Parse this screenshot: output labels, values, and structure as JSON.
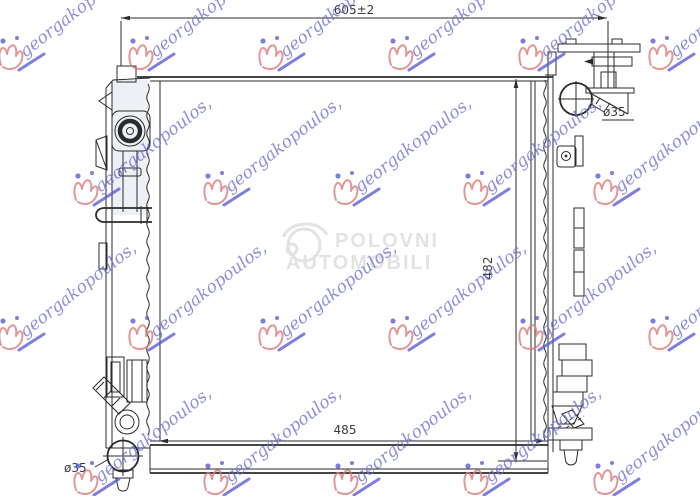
{
  "drawing": {
    "type": "technical-drawing",
    "subject": "radiator front view",
    "line_color": "#2b2b2b",
    "dimensions": {
      "top_width": "605±2",
      "height": "482",
      "core_width": "485",
      "pipe_diameter_top": "ø35",
      "pipe_diameter_bottom": "ø35"
    }
  },
  "watermarks": {
    "script_text": "georgakopoulos,",
    "script_color": "#6f6fd2",
    "logo_color": "#d97a7a",
    "center_title": "POLOVNI",
    "center_subtitle": "AUTOMOBILI",
    "center_color": "#e3e3e3"
  }
}
